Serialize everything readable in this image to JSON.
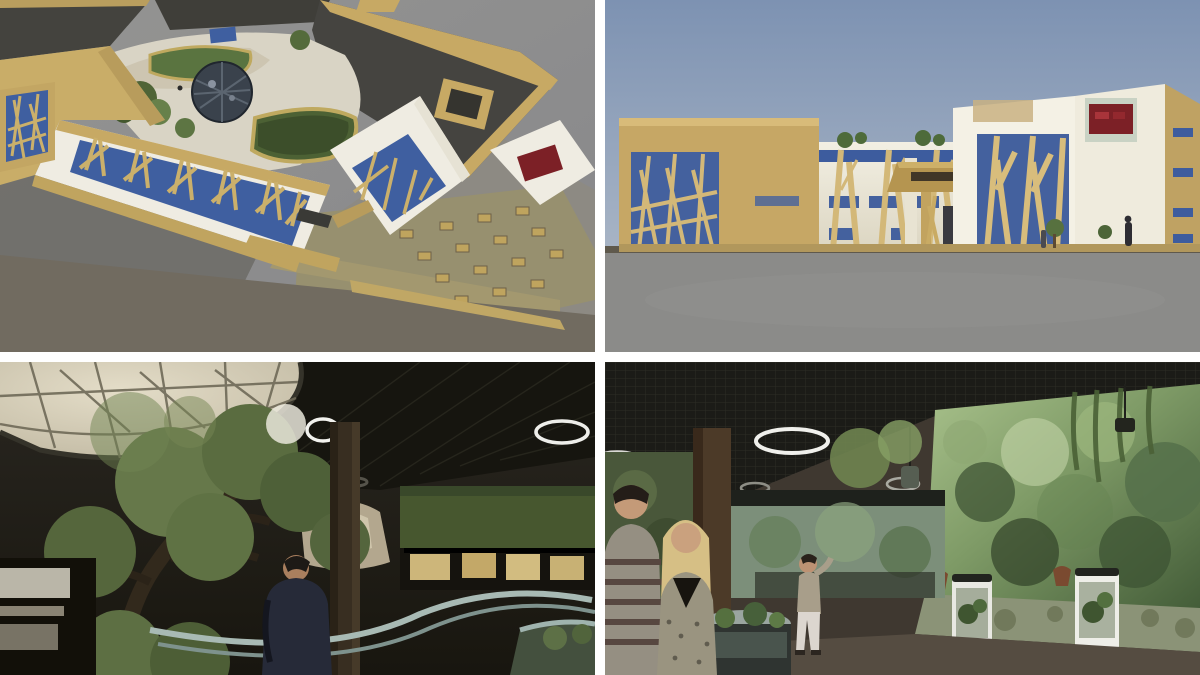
{
  "page": {
    "title": "Aquarium / terrarium building concept – four rendering collage",
    "layout": "2x2 grid of architectural renderings separated by white gutters",
    "divider_color": "#ffffff"
  },
  "panels": [
    {
      "id": "aerial-exterior",
      "position": "top-left",
      "label": "Aerial 3D rendering of building with inner courtyard, geodesic dome, green hedges, branch-lattice facade and plaza with scattered seats",
      "colors": {
        "ground": "#8e8e8c",
        "shadow": "#67665f",
        "roof": "#45443f",
        "parapet_tan": "#c7a964",
        "wall_white": "#efece2",
        "glass_blue": "#3f5fa0",
        "courtyard_paving": "#d9d4c5",
        "hedge_green": "#5a7440",
        "dome": "#3a424c",
        "plaza": "#97906f"
      }
    },
    {
      "id": "street-elevation",
      "position": "top-right",
      "label": "Street-level 3D rendering of facade: tan branch-lattice screens over blue glazing, white volumes, entrance canopy with dark sign and red signboard on upper wall",
      "colors": {
        "sky_top": "#7d92b2",
        "sky_bottom": "#c6cdd6",
        "ground": "#8b8b89",
        "tan_wall": "#c6a765",
        "white_wall": "#eeeadd",
        "lattice": "#d3b878",
        "glass_blue": "#44619e",
        "red_sign": "#7c2026",
        "plinth": "#6d6657"
      }
    },
    {
      "id": "interior-tree-hall",
      "position": "bottom-left",
      "label": "Interior rendering: large tree under translucent dome skylight, dark ceiling with white ring lights, curved railing, visitor in dark coat, lit terrarium windows",
      "colors": {
        "ceiling": "#16150f",
        "dome_skylight": "#d5cdb6",
        "tree_canopy": "#66784a",
        "trunk": "#32291c",
        "hedge_wall": "#47572f",
        "display_glow": "#c8b174",
        "railing": "#a8bab4",
        "visitor_coat": "#262a38",
        "column": "#382e21"
      }
    },
    {
      "id": "interior-exhibit-hall",
      "position": "bottom-right",
      "label": "Interior rendering: visitors beside planted vivarium tanks, huge misty jungle aquarium wall, dark grid ceiling with ring lights",
      "colors": {
        "ceiling": "#1b1b17",
        "mural_green": "#7e9a66",
        "mural_dark": "#3c5233",
        "counter_rock": "#8b9377",
        "floor": "#3f3830",
        "plant_wall": "#49573a",
        "sweater": "#958f82",
        "sweater_stripe": "#574740",
        "blonde_hair": "#d6bf85",
        "skin": "#c49a78",
        "white_pants": "#dcd6cf"
      }
    }
  ],
  "features": {
    "entrance_sign": "dark illegible lettering on tan canopy fascia",
    "red_signboard": "dark red signboard with small unreadable marks on pale backing",
    "ring_lights": "white circular ceiling light fixtures",
    "branch_lattice": "tree-branch shaped timber lattice screens"
  }
}
